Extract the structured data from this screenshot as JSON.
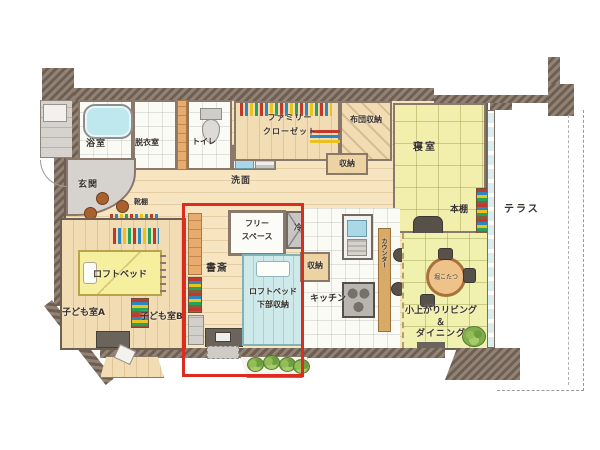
{
  "title": "apartment-floor-plan",
  "rooms": {
    "bath": "浴室",
    "dressing": "脱衣室",
    "toilet": "トイレ",
    "washbasin": "洗面",
    "entrance": "玄関",
    "shoe_shelf": "靴棚",
    "family_closet_line1": "ファミリー",
    "family_closet_line2": "クローゼット",
    "futon_storage": "布団収納",
    "storage_hall": "収納",
    "bedroom": "寝室",
    "bookshelf": "本棚",
    "terrace": "テラス",
    "free_space_line1": "フリー",
    "free_space_line2": "スペース",
    "fridge": "冷",
    "study": "書斎",
    "loft_bed_lower_line1": "ロフトベッド",
    "loft_bed_lower_line2": "下部収納",
    "storage_kitchen": "収納",
    "kitchen": "キッチン",
    "counter": "カウンター",
    "loft_bed": "ロフトベッド",
    "kids_room_a": "子ども室A",
    "kids_room_b": "子ども室B",
    "living_line1": "小上がりリビング",
    "living_line2": "＆",
    "living_line3": "ダイニング",
    "kotatsu": "堀こたつ"
  },
  "colors": {
    "highlight_red": "#dd2b1f",
    "wall_brown": "#7e6e60",
    "wood_floor": "#f7e5c1",
    "tatami_yellow": "#f0f0af",
    "water_blue": "#bfe7ee"
  }
}
